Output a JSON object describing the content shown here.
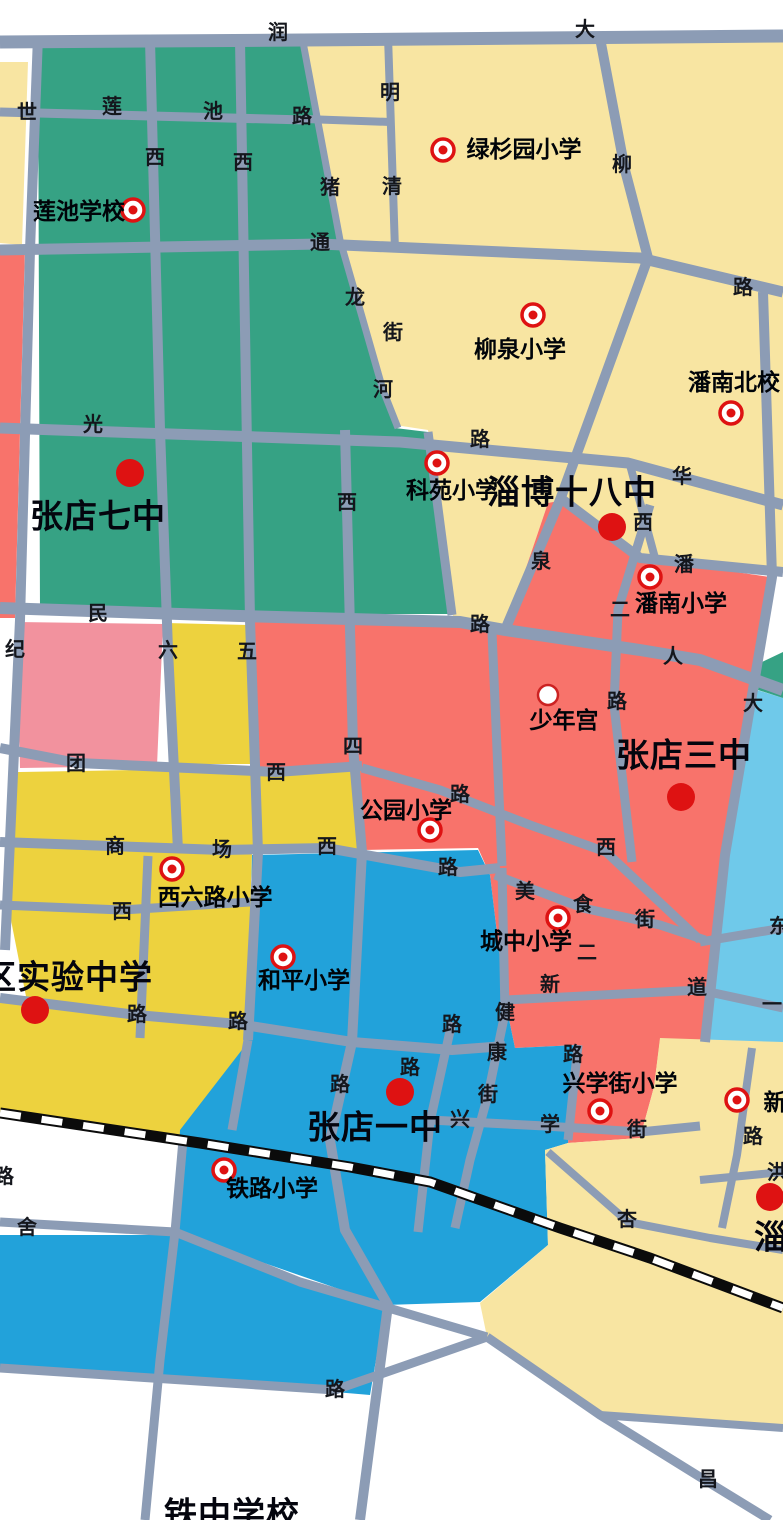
{
  "map": {
    "description": "School district map of Zhangdian, Zibo",
    "colors": {
      "green": "#36A284",
      "cream": "#F8E5A2",
      "yellow": "#EDD23E",
      "salmon": "#F8736B",
      "pink": "#F2929E",
      "blue": "#22A2DA",
      "lblue": "#6FC9EA",
      "road": "#8C9CB5",
      "rail": "#0B0B0B",
      "marker_red": "#DE1212"
    },
    "road_labels": [
      {
        "t": "润",
        "x": 278,
        "y": 33
      },
      {
        "t": "大",
        "x": 585,
        "y": 30
      },
      {
        "t": "世",
        "x": 27,
        "y": 113
      },
      {
        "t": "莲",
        "x": 112,
        "y": 107
      },
      {
        "t": "池",
        "x": 213,
        "y": 112
      },
      {
        "t": "路",
        "x": 302,
        "y": 117
      },
      {
        "t": "明",
        "x": 390,
        "y": 93
      },
      {
        "t": "西",
        "x": 155,
        "y": 158
      },
      {
        "t": "西",
        "x": 243,
        "y": 163
      },
      {
        "t": "猪",
        "x": 330,
        "y": 188
      },
      {
        "t": "清",
        "x": 392,
        "y": 187
      },
      {
        "t": "柳",
        "x": 622,
        "y": 165
      },
      {
        "t": "通",
        "x": 320,
        "y": 243
      },
      {
        "t": "路",
        "x": 743,
        "y": 288
      },
      {
        "t": "龙",
        "x": 355,
        "y": 298
      },
      {
        "t": "街",
        "x": 393,
        "y": 333
      },
      {
        "t": "河",
        "x": 383,
        "y": 390
      },
      {
        "t": "光",
        "x": 93,
        "y": 425
      },
      {
        "t": "路",
        "x": 480,
        "y": 440
      },
      {
        "t": "华",
        "x": 682,
        "y": 477
      },
      {
        "t": "西",
        "x": 347,
        "y": 503
      },
      {
        "t": "西",
        "x": 643,
        "y": 523
      },
      {
        "t": "泉",
        "x": 541,
        "y": 562
      },
      {
        "t": "潘",
        "x": 684,
        "y": 565
      },
      {
        "t": "二",
        "x": 620,
        "y": 610
      },
      {
        "t": "路",
        "x": 480,
        "y": 625
      },
      {
        "t": "民",
        "x": 98,
        "y": 614
      },
      {
        "t": "人",
        "x": 673,
        "y": 657
      },
      {
        "t": "纪",
        "x": 15,
        "y": 650
      },
      {
        "t": "六",
        "x": 168,
        "y": 651
      },
      {
        "t": "五",
        "x": 247,
        "y": 652
      },
      {
        "t": "路",
        "x": 617,
        "y": 702
      },
      {
        "t": "大",
        "x": 753,
        "y": 704
      },
      {
        "t": "团",
        "x": 76,
        "y": 764
      },
      {
        "t": "四",
        "x": 353,
        "y": 747
      },
      {
        "t": "西",
        "x": 276,
        "y": 773
      },
      {
        "t": "路",
        "x": 460,
        "y": 795
      },
      {
        "t": "商",
        "x": 115,
        "y": 847
      },
      {
        "t": "场",
        "x": 222,
        "y": 850
      },
      {
        "t": "西",
        "x": 327,
        "y": 847
      },
      {
        "t": "西",
        "x": 606,
        "y": 848
      },
      {
        "t": "路",
        "x": 448,
        "y": 868
      },
      {
        "t": "美",
        "x": 525,
        "y": 892
      },
      {
        "t": "食",
        "x": 583,
        "y": 905
      },
      {
        "t": "街",
        "x": 645,
        "y": 920
      },
      {
        "t": "西",
        "x": 122,
        "y": 912
      },
      {
        "t": "东",
        "x": 779,
        "y": 927
      },
      {
        "t": "二",
        "x": 587,
        "y": 953
      },
      {
        "t": "新",
        "x": 550,
        "y": 985
      },
      {
        "t": "道",
        "x": 697,
        "y": 988
      },
      {
        "t": "一",
        "x": 772,
        "y": 1005
      },
      {
        "t": "健",
        "x": 505,
        "y": 1013
      },
      {
        "t": "路",
        "x": 137,
        "y": 1015
      },
      {
        "t": "路",
        "x": 238,
        "y": 1022
      },
      {
        "t": "路",
        "x": 452,
        "y": 1025
      },
      {
        "t": "康",
        "x": 497,
        "y": 1053
      },
      {
        "t": "路",
        "x": 573,
        "y": 1055
      },
      {
        "t": "路",
        "x": 410,
        "y": 1068
      },
      {
        "t": "路",
        "x": 340,
        "y": 1085
      },
      {
        "t": "街",
        "x": 488,
        "y": 1095
      },
      {
        "t": "兴",
        "x": 460,
        "y": 1120
      },
      {
        "t": "学",
        "x": 550,
        "y": 1125
      },
      {
        "t": "街",
        "x": 637,
        "y": 1130
      },
      {
        "t": "路",
        "x": 753,
        "y": 1137
      },
      {
        "t": "洪",
        "x": 777,
        "y": 1173
      },
      {
        "t": "路",
        "x": 4,
        "y": 1177
      },
      {
        "t": "杏",
        "x": 627,
        "y": 1220
      },
      {
        "t": "舍",
        "x": 27,
        "y": 1228
      },
      {
        "t": "路",
        "x": 335,
        "y": 1390
      },
      {
        "t": "昌",
        "x": 708,
        "y": 1480
      }
    ],
    "schools": [
      {
        "id": "lianchi-school",
        "name": "莲池学校",
        "marker": "ring",
        "mx": 133,
        "my": 210,
        "lx": 79,
        "ly": 211,
        "major": false
      },
      {
        "id": "lvshanyuan-primary",
        "name": "绿杉园小学",
        "marker": "ring",
        "mx": 443,
        "my": 150,
        "lx": 524,
        "ly": 149,
        "major": false
      },
      {
        "id": "liuquan-primary",
        "name": "柳泉小学",
        "marker": "ring",
        "mx": 533,
        "my": 315,
        "lx": 520,
        "ly": 349,
        "major": false
      },
      {
        "id": "pannan-north-school",
        "name": "潘南北校",
        "marker": "ring",
        "mx": 731,
        "my": 413,
        "lx": 734,
        "ly": 382,
        "major": false
      },
      {
        "id": "keyuan-primary",
        "name": "科苑小学",
        "marker": "ring",
        "mx": 437,
        "my": 463,
        "lx": 452,
        "ly": 490,
        "major": false
      },
      {
        "id": "zibo-no18-middle",
        "name": "淄博十八中",
        "marker": "dot",
        "mx": 612,
        "my": 527,
        "lx": 572,
        "ly": 492,
        "major": true
      },
      {
        "id": "pannan-primary",
        "name": "潘南小学",
        "marker": "ring",
        "mx": 650,
        "my": 577,
        "lx": 681,
        "ly": 603,
        "major": false
      },
      {
        "id": "youth-palace",
        "name": "少年宫",
        "marker": "whitedot",
        "mx": 548,
        "my": 695,
        "lx": 564,
        "ly": 720,
        "major": false
      },
      {
        "id": "zhangdian-no7-middle",
        "name": "张店七中",
        "marker": "dot",
        "mx": 130,
        "my": 473,
        "lx": 98,
        "ly": 516,
        "major": true
      },
      {
        "id": "zhangdian-no3-middle",
        "name": "张店三中",
        "marker": "dot",
        "mx": 681,
        "my": 797,
        "lx": 684,
        "ly": 755,
        "major": true
      },
      {
        "id": "gongyuan-primary",
        "name": "公园小学",
        "marker": "ring",
        "mx": 430,
        "my": 830,
        "lx": 406,
        "ly": 810,
        "major": false
      },
      {
        "id": "xiliulu-primary",
        "name": "西六路小学",
        "marker": "ring",
        "mx": 172,
        "my": 869,
        "lx": 215,
        "ly": 897,
        "major": false
      },
      {
        "id": "chengzhong-primary",
        "name": "城中小学",
        "marker": "ring",
        "mx": 558,
        "my": 918,
        "lx": 526,
        "ly": 941,
        "major": false
      },
      {
        "id": "heping-primary",
        "name": "和平小学",
        "marker": "ring",
        "mx": 283,
        "my": 957,
        "lx": 304,
        "ly": 980,
        "major": false
      },
      {
        "id": "district-experimental-middle",
        "name": "区实验中学",
        "marker": "dot",
        "mx": 35,
        "my": 1010,
        "lx": 68,
        "ly": 977,
        "major": true
      },
      {
        "id": "xin-school-partial",
        "name": "新",
        "marker": "ring",
        "mx": 737,
        "my": 1100,
        "lx": 775,
        "ly": 1102,
        "major": false
      },
      {
        "id": "xingxuejie-primary",
        "name": "兴学街小学",
        "marker": "ring",
        "mx": 600,
        "my": 1111,
        "lx": 620,
        "ly": 1083,
        "major": false
      },
      {
        "id": "zhangdian-no1-middle",
        "name": "张店一中",
        "marker": "dot",
        "mx": 400,
        "my": 1092,
        "lx": 375,
        "ly": 1127,
        "major": true
      },
      {
        "id": "tielu-primary",
        "name": "铁路小学",
        "marker": "ring",
        "mx": 224,
        "my": 1170,
        "lx": 272,
        "ly": 1188,
        "major": false
      },
      {
        "id": "zibo-school-partial",
        "name": "淄",
        "marker": "dot",
        "mx": 770,
        "my": 1197,
        "lx": 771,
        "ly": 1237,
        "major": true
      },
      {
        "id": "tiezhong-school-partial",
        "name": "铁中学校",
        "marker": "none",
        "mx": null,
        "my": null,
        "lx": 232,
        "ly": 1514,
        "major": true
      }
    ]
  }
}
